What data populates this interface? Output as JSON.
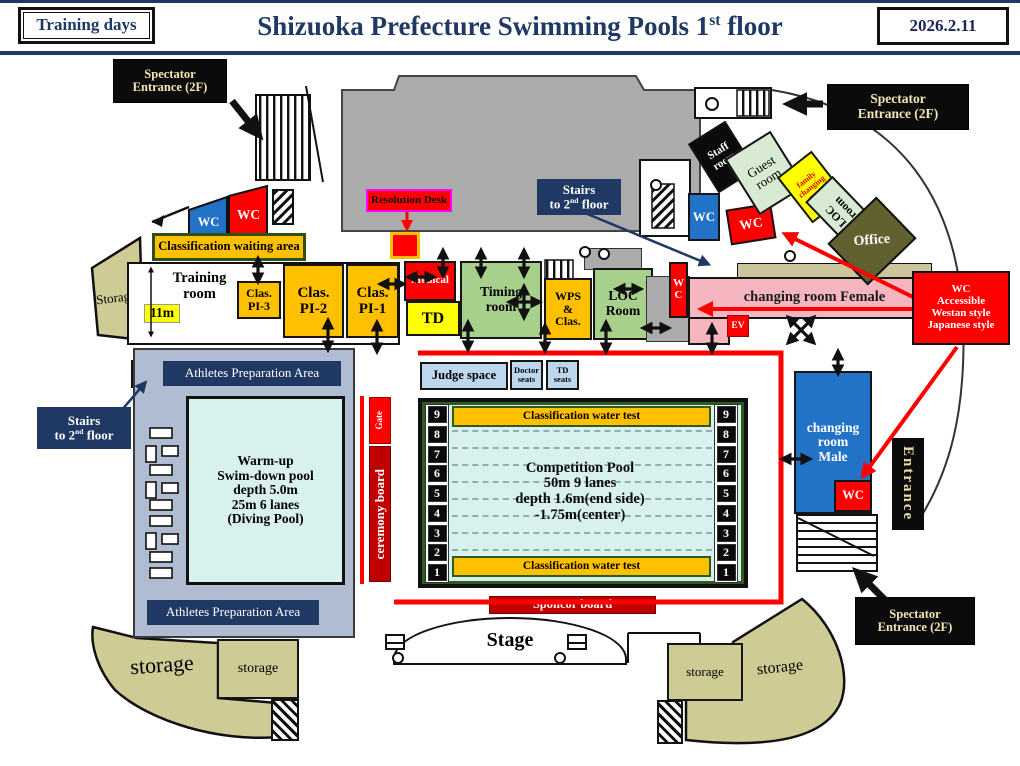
{
  "colors": {
    "navy": "#1F3864",
    "red": "#FF0000",
    "dark_red": "#C00000",
    "orange": "#FFC000",
    "yellow": "#FFFF00",
    "room_green": "#A8D08D",
    "pale_green": "#D9EAD3",
    "pink": "#F5B6C0",
    "blue": "#2272C8",
    "pool_cyan": "#D8F1EF",
    "khaki": "#CFCB94",
    "olive": "#61612F",
    "building_gray": "#ABABAB",
    "deck_blue_gray": "#AFBCD2",
    "seat_light_blue": "#BDD7EE",
    "callout_text": "#F2E6B4",
    "magenta_border": "#FF00FF"
  },
  "header": {
    "training_days": "Training days",
    "title_prefix": "Shizuoka Prefecture Swimming Pools 1",
    "title_sup": "st",
    "title_suffix": " floor",
    "date": "2026.2.11"
  },
  "callouts": {
    "spectator_entrance": "Spectator\nEntrance (2F)",
    "resolution_desk": "Resolution Desk",
    "stairs_line1": "Stairs",
    "stairs_line2_pre": "to 2",
    "stairs_sup": "nd",
    "stairs_line2_post": " floor",
    "wc_accessible": "WC\nAccessible\nWestan style\nJapanese style"
  },
  "rooms": {
    "staff_room": "Staff\nroom",
    "guest_room": "Guest\nroom",
    "family_changing_room": "family\nchanging\nroom",
    "loc_room_upper": "LOC\nroom",
    "office": "Office",
    "wc": "WC",
    "wc_stacked": "W\nC",
    "ev": "EV",
    "storage_upper_left": "Storage",
    "classification_waiting_area": "Classification waiting area",
    "training_room": "Training\nroom",
    "training_room_width": "11m",
    "clas_pi3": "Clas.\nPI-3",
    "clas_pi2": "Clas.\nPI-2",
    "clas_pi1": "Clas.\nPI-1",
    "medical": "Medical",
    "td": "TD",
    "timing_room": "Timing\nroom",
    "wps_clas": "WPS\n&\nClas.",
    "loc_room": "LOC\nRoom",
    "changing_room_female": "changing room Female",
    "changing_room_male": "changing\nroom\nMale",
    "entrance": "Entrance",
    "storage": "storage"
  },
  "pool_area": {
    "judge_space": "Judge space",
    "doctor_seats": "Doctor\nseats",
    "td_seats": "TD\nseats",
    "classification_water_test": "Classification water test",
    "competition_pool": "Competition Pool\n50m 9 lanes\ndepth 1.6m(end side)\n-1.75m(center)",
    "lane_numbers": [
      "9",
      "8",
      "7",
      "6",
      "5",
      "4",
      "3",
      "2",
      "1"
    ],
    "warmup_pool": "Warm-up\nSwim-down pool\ndepth 5.0m\n25m 6 lanes\n(Diving Pool)",
    "athletes_preparation_area": "Athletes Preparation Area",
    "gate": "Gate",
    "ceremony_board": "ceremony board",
    "sponcor_board": "Sponcor board",
    "stage": "Stage"
  }
}
